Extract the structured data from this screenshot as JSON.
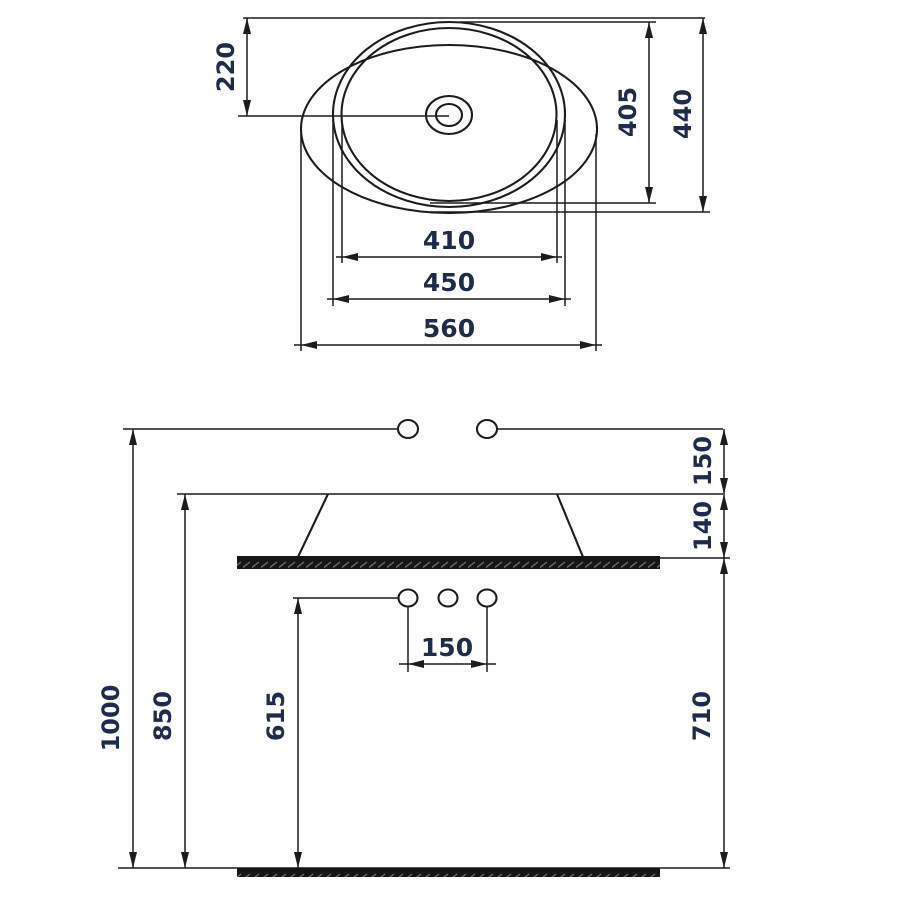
{
  "drawing": {
    "top_view": {
      "center_from_top": "220",
      "bowl_depth": "405",
      "overall_depth": "440",
      "bowl_inner_width": "410",
      "bowl_outer_width": "450",
      "overall_width": "560"
    },
    "side_view": {
      "faucet_height": "1000",
      "rim_height": "850",
      "supply_height": "615",
      "faucet_above_rim": "150",
      "basin_body_height": "140",
      "counter_to_floor": "710",
      "hole_spacing": "150"
    },
    "colors": {
      "line": "#1c1c1c",
      "dimension_text": "#1e2a4e",
      "surface_fill": "#161616"
    }
  }
}
